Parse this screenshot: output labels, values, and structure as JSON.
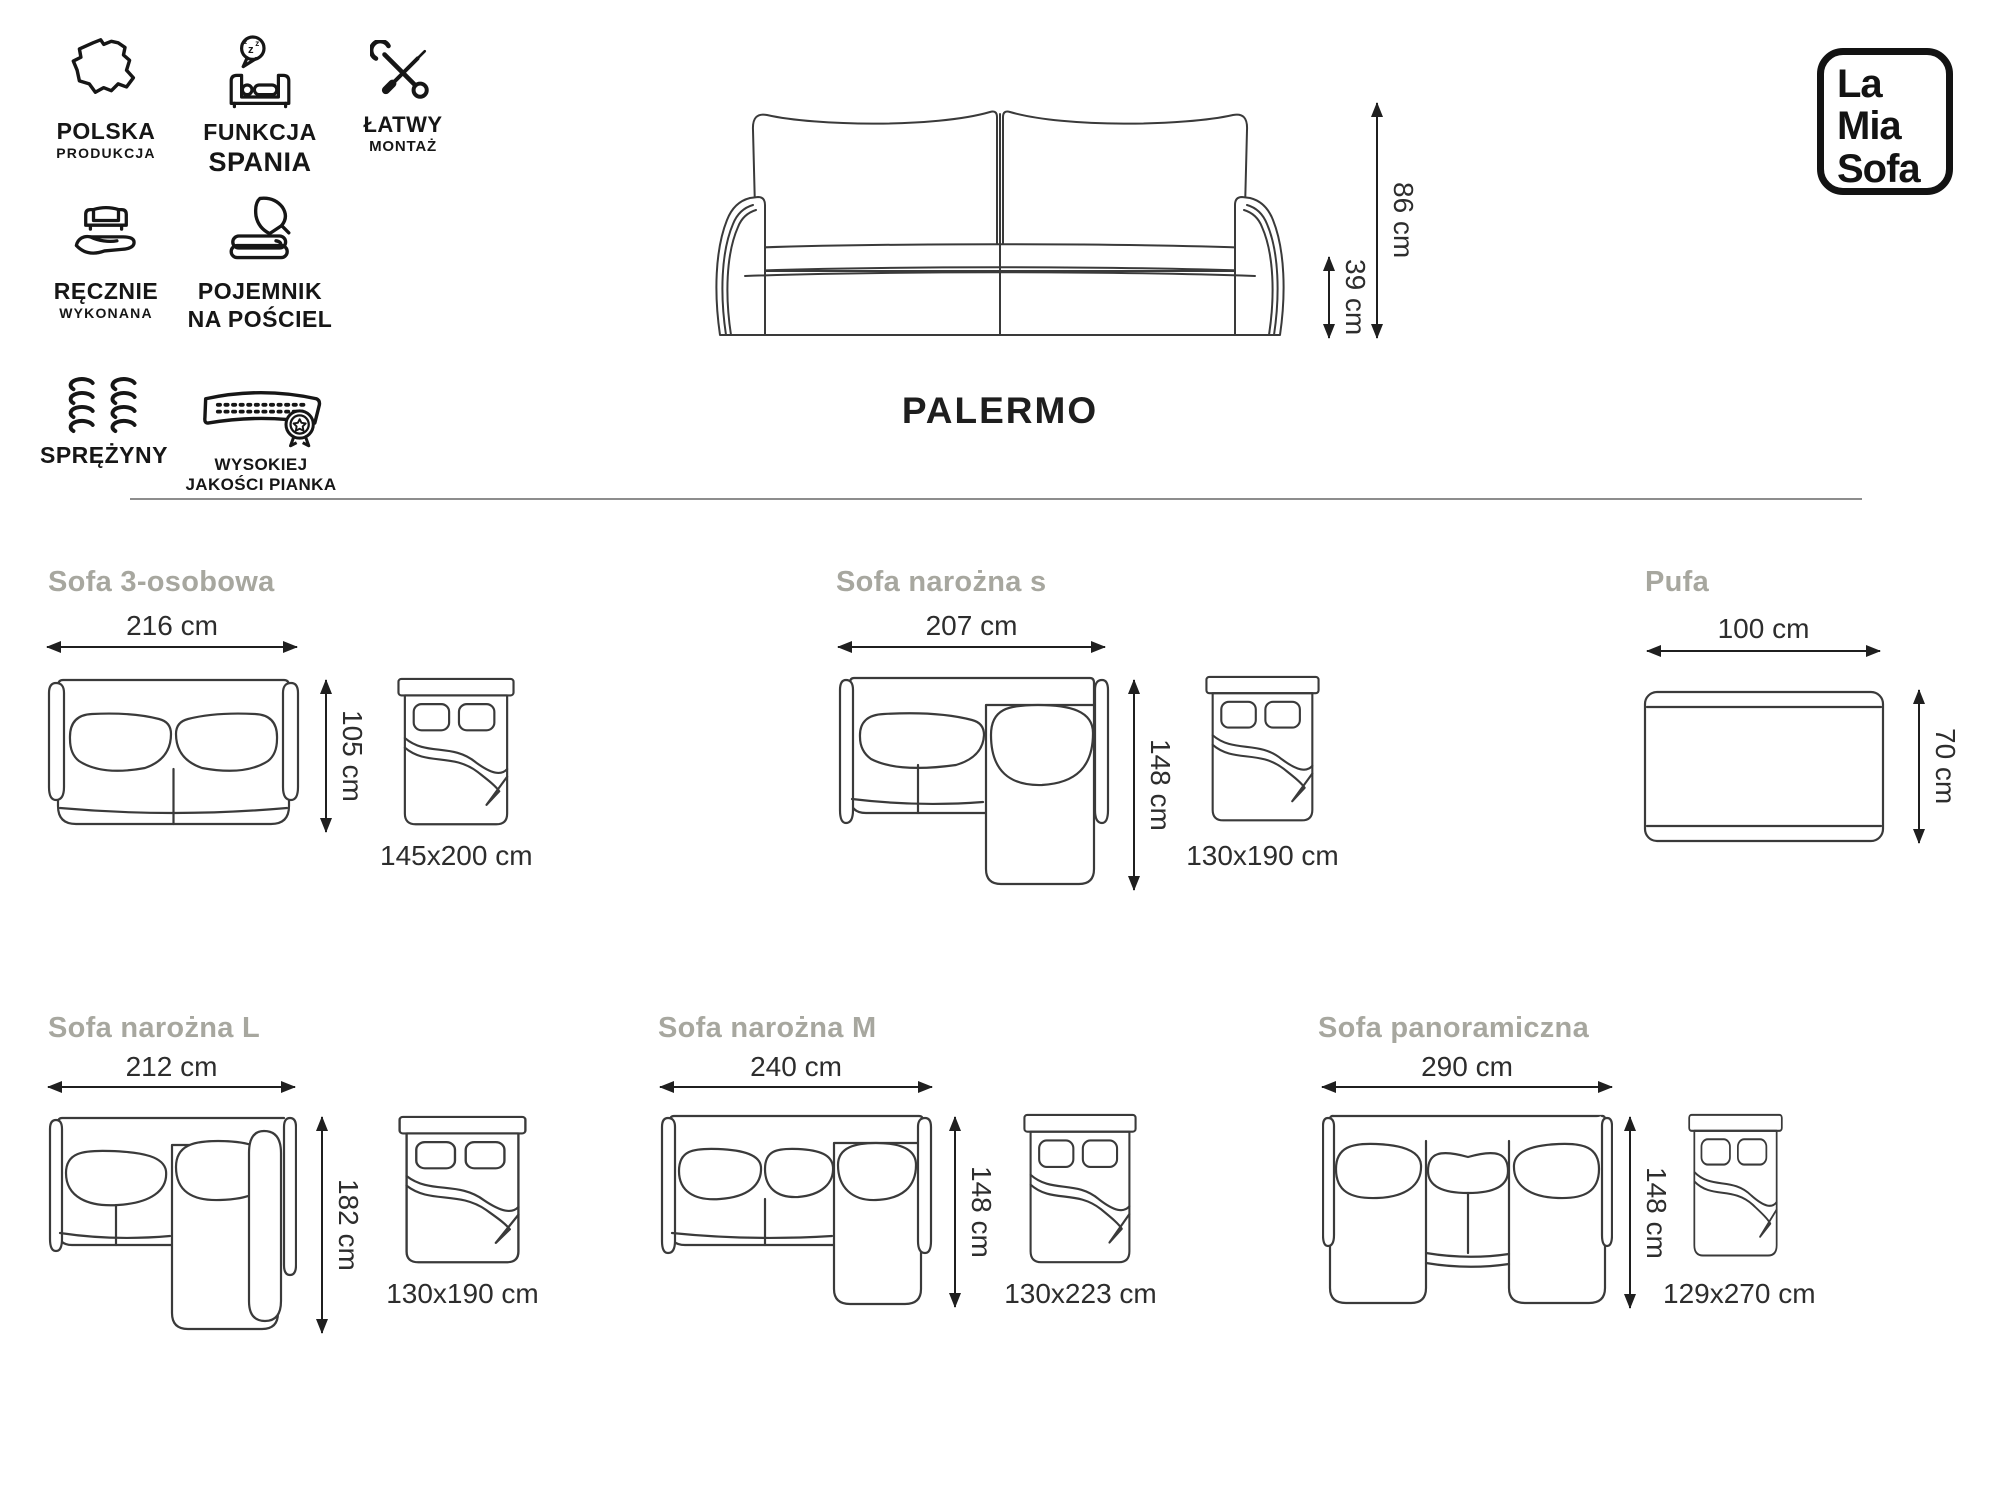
{
  "colors": {
    "title_gray": "#a7a79f",
    "ink": "#1c1c1c",
    "line_art": "#3a3a3a",
    "divider": "#8d8d8d"
  },
  "header": {
    "features": [
      {
        "icon": "poland-map-icon",
        "lines": [
          "POLSKA",
          "PRODUKCJA"
        ]
      },
      {
        "icon": "sleep-function-icon",
        "lines": [
          "FUNKCJA",
          "SPANIA"
        ]
      },
      {
        "icon": "easy-assembly-icon",
        "lines": [
          "ŁATWY",
          "MONTAŻ"
        ]
      },
      {
        "icon": "handmade-icon",
        "lines": [
          "RĘCZNIE",
          "WYKONANA"
        ]
      },
      {
        "icon": "bedding-storage-icon",
        "lines": [
          "POJEMNIK",
          "NA POŚCIEL"
        ]
      },
      {
        "icon": "springs-icon",
        "lines": [
          "SPRĘŻYNY",
          ""
        ]
      },
      {
        "icon": "high-quality-foam-icon",
        "lines": [
          "WYSOKIEJ",
          "JAKOŚCI PIANKA"
        ]
      }
    ],
    "product_name": "PALERMO",
    "total_height": "86 cm",
    "seat_height": "39 cm",
    "logo": {
      "line1": "La",
      "line2": "Mia",
      "line3": "Sofa"
    }
  },
  "variants": [
    {
      "name": "Sofa 3-osobowa",
      "width": "216 cm",
      "depth": "105 cm",
      "bed_size": "145x200 cm"
    },
    {
      "name": "Sofa narożna s",
      "width": "207 cm",
      "depth": "148 cm",
      "bed_size": "130x190 cm"
    },
    {
      "name": "Pufa",
      "width": "100 cm",
      "depth": "70 cm"
    },
    {
      "name": "Sofa narożna L",
      "width": "212 cm",
      "depth": "182 cm",
      "bed_size": "130x190 cm"
    },
    {
      "name": "Sofa narożna M",
      "width": "240 cm",
      "depth": "148 cm",
      "bed_size": "130x223 cm"
    },
    {
      "name": "Sofa panoramiczna",
      "width": "290 cm",
      "depth": "148 cm",
      "bed_size": "129x270 cm"
    }
  ]
}
